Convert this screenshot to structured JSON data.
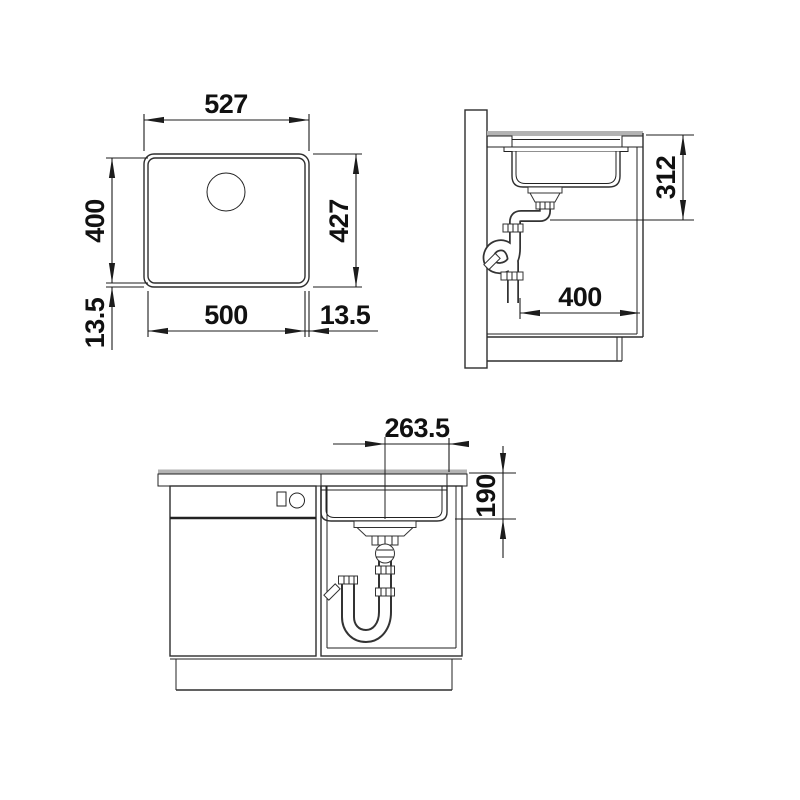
{
  "title": "undermount-sink-installation-drawing",
  "colors": {
    "line": "#2e2e2e",
    "worktop_surface": "#b3b3b3",
    "background": "#ffffff"
  },
  "dimensions": {
    "plan": {
      "outer_width": "527",
      "outer_depth": "427",
      "bowl_depth": "400",
      "bowl_width": "500",
      "rim_left": "13.5",
      "rim_right": "13.5"
    },
    "side": {
      "outlet_height": "312",
      "outlet_distance": "400"
    },
    "front": {
      "drain_center_offset": "263.5",
      "bowl_depth": "190"
    }
  }
}
